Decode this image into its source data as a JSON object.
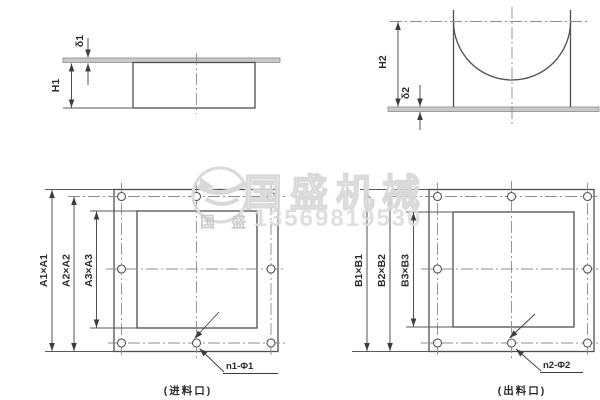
{
  "drawing": {
    "side_view_inlet": {
      "height_label": "H1",
      "thickness_label": "δ1"
    },
    "side_view_outlet": {
      "height_label": "H2",
      "thickness_label": "δ2"
    },
    "inlet_face": {
      "outer_dim": "A1×A1",
      "bolt_square_dim": "A2×A2",
      "opening_dim": "A3×A3",
      "holes_label": "n1-Φ1",
      "hole_count": 8,
      "caption": "(进料口)"
    },
    "outlet_face": {
      "outer_dim": "B1×B1",
      "bolt_square_dim": "B2×B2",
      "opening_dim": "B3×B3",
      "holes_label": "n2-Φ2",
      "hole_count": 8,
      "caption": "(出料口)"
    }
  },
  "watermark": {
    "brand": "国盛机械",
    "brand_small": "国 盛",
    "phone": "13569819530"
  },
  "colors": {
    "line": "#4f4f4f",
    "centerline": "#8c8c8c",
    "plate_fill": "#c9c9c9",
    "watermark": "#dcdcdc"
  }
}
